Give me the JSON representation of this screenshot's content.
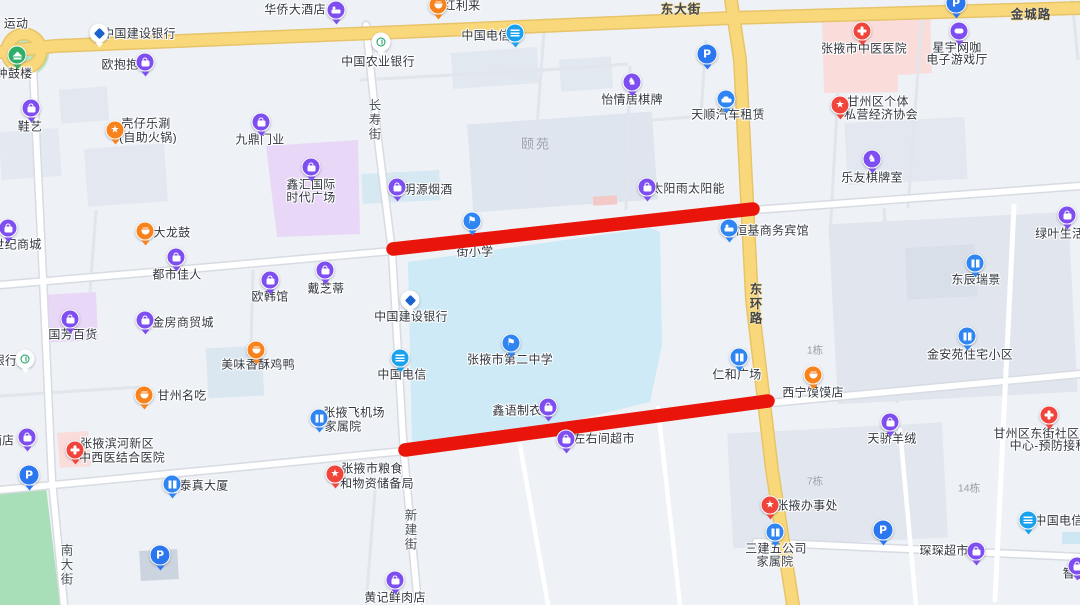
{
  "colors": {
    "highlight": "#e9150b",
    "purple": "#7e4ef1",
    "blue": "#2f85f2",
    "telecom": "#1ba2ef",
    "orange": "#f8821c",
    "red": "#f0453c",
    "green": "#2fae67",
    "white": "#ffffff",
    "parking": "#2b77f0",
    "road_yellow": "#f9d87b",
    "school_area": "#cdeaf6",
    "hospital_area": "#fadcdb",
    "commercial_area": "#e9d7f8",
    "park_green": "#a8dfb8"
  },
  "icons": {
    "shop": {
      "data_name": "bag-icon",
      "glyph": "bag"
    },
    "cart": {
      "data_name": "cart-icon",
      "glyph": "bag"
    },
    "hotel": {
      "data_name": "bed-icon",
      "glyph": "bed"
    },
    "hospital": {
      "data_name": "red-cross-icon",
      "glyph": "cross"
    },
    "star": {
      "data_name": "star-icon",
      "glyph": "txt",
      "char": "★"
    },
    "flag": {
      "data_name": "school-flag-icon",
      "glyph": "txt",
      "char": "⚑"
    },
    "knight": {
      "data_name": "chess-knight-icon",
      "glyph": "txt",
      "char": "♞"
    },
    "food": {
      "data_name": "food-bowl-icon",
      "glyph": "bowl"
    },
    "building": {
      "data_name": "building-icon",
      "glyph": "building"
    },
    "car": {
      "data_name": "car-icon",
      "glyph": "car"
    },
    "telecom": {
      "data_name": "telecom-icon",
      "glyph": "telecom"
    },
    "ccb": {
      "data_name": "ccb-bank-icon",
      "glyph": "ccb"
    },
    "abc": {
      "data_name": "abc-bank-icon",
      "glyph": "abc"
    },
    "pagoda": {
      "data_name": "pagoda-icon",
      "glyph": "pagoda"
    },
    "game": {
      "data_name": "game-icon",
      "glyph": "game"
    }
  },
  "highlight": {
    "segments": [
      {
        "x1": 393,
        "y1": 249,
        "x2": 753,
        "y2": 209
      },
      {
        "x1": 405,
        "y1": 450,
        "x2": 768,
        "y2": 401
      }
    ],
    "stroke_width": 13.5
  },
  "map": {
    "road_labels": [
      {
        "id": "dongdajie",
        "text": "东大街",
        "x": 681,
        "y": 8,
        "v": false,
        "on_yellow": true
      },
      {
        "id": "jinchenglu",
        "text": "金城路",
        "x": 1031,
        "y": 13,
        "v": false,
        "on_yellow": true
      },
      {
        "id": "donghuanlu",
        "text": "东环路",
        "x": 755,
        "y": 304,
        "v": true,
        "on_yellow": true
      },
      {
        "id": "changshoujie",
        "text": "长寿街",
        "x": 374,
        "y": 120,
        "v": true,
        "on_yellow": false
      },
      {
        "id": "xinjianjie",
        "text": "新建街",
        "x": 410,
        "y": 530,
        "v": true,
        "on_yellow": false
      },
      {
        "id": "nandajie",
        "text": "南大街",
        "x": 66,
        "y": 565,
        "v": true,
        "on_yellow": false
      }
    ],
    "area_labels": [
      {
        "id": "yiyuan",
        "text": "颐苑",
        "x": 536,
        "y": 143,
        "small": false
      },
      {
        "id": "dong-1",
        "text": "1栋",
        "x": 815,
        "y": 350,
        "small": true
      },
      {
        "id": "dong-7",
        "text": "7栋",
        "x": 815,
        "y": 481,
        "small": true
      },
      {
        "id": "dong-14",
        "text": "14栋",
        "x": 969,
        "y": 488,
        "small": true
      }
    ],
    "parking": [
      {
        "id": "parking-top-center",
        "x": 707,
        "y": 54
      },
      {
        "id": "parking-top-right",
        "x": 956,
        "y": 3
      },
      {
        "id": "parking-left",
        "x": 29,
        "y": 475
      },
      {
        "id": "parking-bottom-left",
        "x": 160,
        "y": 555
      },
      {
        "id": "parking-bottom-right",
        "x": 883,
        "y": 530
      }
    ],
    "pois": [
      {
        "id": "sports-fragment",
        "icon": "none",
        "color": "purple",
        "x": 16,
        "y": 23,
        "lines": [
          {
            "text": "运动",
            "cx": 16,
            "cy": 23
          }
        ]
      },
      {
        "id": "bell-drum-tower",
        "icon": "pagoda",
        "color": "green",
        "x": 17,
        "y": 55,
        "lines": [
          {
            "text": "钟鼓楼",
            "cx": 14,
            "cy": 73
          }
        ]
      },
      {
        "id": "ccb-bank-north",
        "icon": "ccb",
        "color": "white",
        "x": 99,
        "y": 33,
        "lines": [
          {
            "text": "中国建设银行",
            "cx": 139,
            "cy": 33
          }
        ]
      },
      {
        "id": "huaqiao-hotel",
        "icon": "hotel",
        "color": "purple",
        "x": 336,
        "y": 10,
        "lines": [
          {
            "text": "华侨大酒店",
            "cx": 295,
            "cy": 9
          }
        ]
      },
      {
        "id": "honglilai",
        "icon": "food",
        "color": "orange",
        "x": 438,
        "y": 5,
        "lines": [
          {
            "text": "红利来",
            "cx": 462,
            "cy": 5
          }
        ]
      },
      {
        "id": "china-telecom-north",
        "icon": "telecom",
        "color": "telecom",
        "x": 515,
        "y": 33,
        "lines": [
          {
            "text": "中国电信",
            "cx": 486,
            "cy": 35
          }
        ]
      },
      {
        "id": "ou-baobao",
        "icon": "shop",
        "color": "purple",
        "x": 145,
        "y": 62,
        "lines": [
          {
            "text": "欧抱抱",
            "cx": 120,
            "cy": 64
          }
        ]
      },
      {
        "id": "abc-bank",
        "icon": "abc",
        "color": "white",
        "x": 381,
        "y": 42,
        "lines": [
          {
            "text": "中国农业银行",
            "cx": 378,
            "cy": 61
          }
        ]
      },
      {
        "id": "xieyi-shoes",
        "icon": "shop",
        "color": "purple",
        "x": 31,
        "y": 108,
        "lines": [
          {
            "text": "鞋艺",
            "cx": 30,
            "cy": 126
          }
        ]
      },
      {
        "id": "kezai-hotpot",
        "icon": "star",
        "color": "orange",
        "x": 115,
        "y": 130,
        "lines": [
          {
            "text": "壳仔乐涮",
            "cx": 146,
            "cy": 123
          },
          {
            "text": "(自助火锅)",
            "cx": 148,
            "cy": 137
          }
        ]
      },
      {
        "id": "jiuding-doors",
        "icon": "shop",
        "color": "purple",
        "x": 261,
        "y": 122,
        "lines": [
          {
            "text": "九鼎门业",
            "cx": 260,
            "cy": 139
          }
        ]
      },
      {
        "id": "xinhui-plaza",
        "icon": "shop",
        "color": "purple",
        "x": 311,
        "y": 167,
        "lines": [
          {
            "text": "鑫汇国际",
            "cx": 311,
            "cy": 184
          },
          {
            "text": "时代广场",
            "cx": 311,
            "cy": 197
          }
        ]
      },
      {
        "id": "yiqingju-mahjong",
        "icon": "knight",
        "color": "purple",
        "x": 632,
        "y": 82,
        "lines": [
          {
            "text": "怡情居棋牌",
            "cx": 632,
            "cy": 99
          }
        ]
      },
      {
        "id": "tianshun-car-rental",
        "icon": "car",
        "color": "blue",
        "x": 726,
        "y": 99,
        "lines": [
          {
            "text": "天顺汽车租赁",
            "cx": 728,
            "cy": 114
          }
        ]
      },
      {
        "id": "xingyu-netcafe",
        "icon": "game",
        "color": "purple",
        "x": 959,
        "y": 31,
        "lines": [
          {
            "text": "星宇网咖",
            "cx": 957,
            "cy": 47
          },
          {
            "text": "电子游戏厅",
            "cx": 957,
            "cy": 59
          }
        ]
      },
      {
        "id": "zhangye-tcm-hospital",
        "icon": "hospital",
        "color": "red",
        "x": 862,
        "y": 31,
        "lines": [
          {
            "text": "张掖市中医医院",
            "cx": 864,
            "cy": 48
          }
        ]
      },
      {
        "id": "private-economy-association",
        "icon": "star",
        "color": "red",
        "x": 840,
        "y": 105,
        "lines": [
          {
            "text": "甘州区个体",
            "cx": 878,
            "cy": 101
          },
          {
            "text": "私营经济协会",
            "cx": 881,
            "cy": 114
          }
        ]
      },
      {
        "id": "leyou-chess-room",
        "icon": "knight",
        "color": "purple",
        "x": 872,
        "y": 159,
        "lines": [
          {
            "text": "乐友棋牌室",
            "cx": 872,
            "cy": 177
          }
        ]
      },
      {
        "id": "mingyuan-tobacco",
        "icon": "shop",
        "color": "purple",
        "x": 397,
        "y": 187,
        "lines": [
          {
            "text": "明源烟酒",
            "cx": 428,
            "cy": 189
          }
        ]
      },
      {
        "id": "taiyangyu-solar",
        "icon": "shop",
        "color": "purple",
        "x": 647,
        "y": 187,
        "lines": [
          {
            "text": "太阳雨太阳能",
            "cx": 688,
            "cy": 188
          }
        ]
      },
      {
        "id": "school-fragment",
        "icon": "flag",
        "color": "blue",
        "x": 472,
        "y": 221,
        "lines": [
          {
            "text": "街小学",
            "cx": 475,
            "cy": 251
          }
        ]
      },
      {
        "id": "hengji-hotel",
        "icon": "hotel",
        "color": "blue",
        "x": 729,
        "y": 228,
        "lines": [
          {
            "text": "恒基商务宾馆",
            "cx": 772,
            "cy": 230
          }
        ]
      },
      {
        "id": "lvye-life-supermarket",
        "icon": "cart",
        "color": "purple",
        "x": 1067,
        "y": 215,
        "lines": [
          {
            "text": "绿叶生活超市",
            "cx": 1072,
            "cy": 233
          }
        ]
      },
      {
        "id": "dongchen-ruijing",
        "icon": "building",
        "color": "blue",
        "x": 975,
        "y": 263,
        "lines": [
          {
            "text": "东辰瑞景",
            "cx": 976,
            "cy": 279
          }
        ]
      },
      {
        "id": "dalonggu",
        "icon": "food",
        "color": "orange",
        "x": 145,
        "y": 231,
        "lines": [
          {
            "text": "大龙鼓",
            "cx": 172,
            "cy": 232
          }
        ]
      },
      {
        "id": "dushi-jiaren",
        "icon": "shop",
        "color": "purple",
        "x": 176,
        "y": 257,
        "lines": [
          {
            "text": "都市佳人",
            "cx": 177,
            "cy": 274
          }
        ]
      },
      {
        "id": "ouhan-guan",
        "icon": "shop",
        "color": "purple",
        "x": 270,
        "y": 280,
        "lines": [
          {
            "text": "欧韩馆",
            "cx": 270,
            "cy": 296
          }
        ]
      },
      {
        "id": "daizhidi",
        "icon": "shop",
        "color": "purple",
        "x": 325,
        "y": 270,
        "lines": [
          {
            "text": "戴芝蒂",
            "cx": 326,
            "cy": 288
          }
        ]
      },
      {
        "id": "shiji-mall",
        "icon": "cart",
        "color": "purple",
        "x": 8,
        "y": 228,
        "lines": [
          {
            "text": "世纪商城",
            "cx": 17,
            "cy": 244
          }
        ]
      },
      {
        "id": "ccb-bank-mid",
        "icon": "ccb",
        "color": "white",
        "x": 410,
        "y": 300,
        "lines": [
          {
            "text": "中国建设银行",
            "cx": 411,
            "cy": 316
          }
        ]
      },
      {
        "id": "guofang-department-store",
        "icon": "shop",
        "color": "purple",
        "x": 70,
        "y": 319,
        "lines": [
          {
            "text": "国芳百货",
            "cx": 73,
            "cy": 334
          }
        ]
      },
      {
        "id": "jinfang-trade-city",
        "icon": "shop",
        "color": "purple",
        "x": 145,
        "y": 320,
        "lines": [
          {
            "text": "金房商贸城",
            "cx": 183,
            "cy": 322
          }
        ]
      },
      {
        "id": "meiwei-chicken-duck",
        "icon": "food",
        "color": "orange",
        "x": 256,
        "y": 350,
        "lines": [
          {
            "text": "美味香酥鸡鸭",
            "cx": 258,
            "cy": 364
          }
        ]
      },
      {
        "id": "zhangye-no2-middle-school",
        "icon": "flag",
        "color": "blue",
        "x": 511,
        "y": 343,
        "lines": [
          {
            "text": "张掖市第二中学",
            "cx": 510,
            "cy": 359
          }
        ]
      },
      {
        "id": "china-telecom-mid",
        "icon": "telecom",
        "color": "telecom",
        "x": 400,
        "y": 358,
        "lines": [
          {
            "text": "中国电信",
            "cx": 402,
            "cy": 374
          }
        ]
      },
      {
        "id": "renhe-plaza",
        "icon": "building",
        "color": "blue",
        "x": 739,
        "y": 357,
        "lines": [
          {
            "text": "仁和广场",
            "cx": 737,
            "cy": 374
          }
        ]
      },
      {
        "id": "xining-momo-shop",
        "icon": "food",
        "color": "orange",
        "x": 813,
        "y": 375,
        "lines": [
          {
            "text": "西宁馍馍店",
            "cx": 813,
            "cy": 392
          }
        ]
      },
      {
        "id": "jinanyuan-residence",
        "icon": "building",
        "color": "blue",
        "x": 967,
        "y": 336,
        "lines": [
          {
            "text": "金安苑住宅小区",
            "cx": 970,
            "cy": 354
          }
        ]
      },
      {
        "id": "ganzhou-snacks",
        "icon": "food",
        "color": "orange",
        "x": 144,
        "y": 395,
        "lines": [
          {
            "text": "甘州名吃",
            "cx": 182,
            "cy": 395
          }
        ]
      },
      {
        "id": "bank-fragment-left",
        "icon": "abc",
        "color": "white",
        "x": 25,
        "y": 359,
        "lines": [
          {
            "text": "银行",
            "cx": 5,
            "cy": 360
          }
        ]
      },
      {
        "id": "shop-fragment-left",
        "icon": "shop",
        "color": "purple",
        "x": 27,
        "y": 437,
        "lines": [
          {
            "text": "酒店",
            "cx": 2,
            "cy": 440
          }
        ]
      },
      {
        "id": "airport-family-compound",
        "icon": "building",
        "color": "blue",
        "x": 319,
        "y": 418,
        "lines": [
          {
            "text": "张掖飞机场",
            "cx": 354,
            "cy": 412
          },
          {
            "text": "家属院",
            "cx": 343,
            "cy": 426
          }
        ]
      },
      {
        "id": "binhe-hospital",
        "icon": "hospital",
        "color": "red",
        "x": 75,
        "y": 450,
        "lines": [
          {
            "text": "张掖滨河新区",
            "cx": 117,
            "cy": 443
          },
          {
            "text": "中西医结合医院",
            "cx": 122,
            "cy": 457
          }
        ]
      },
      {
        "id": "grain-reserve-bureau",
        "icon": "star",
        "color": "red",
        "x": 335,
        "y": 474,
        "lines": [
          {
            "text": "张掖市粮食",
            "cx": 372,
            "cy": 468
          },
          {
            "text": "和物资储备局",
            "cx": 377,
            "cy": 483
          }
        ]
      },
      {
        "id": "taizhen-tower",
        "icon": "building",
        "color": "blue",
        "x": 172,
        "y": 484,
        "lines": [
          {
            "text": "泰真大厦",
            "cx": 204,
            "cy": 485
          }
        ]
      },
      {
        "id": "xinyu-garment",
        "icon": "shop",
        "color": "purple",
        "x": 548,
        "y": 407,
        "lines": [
          {
            "text": "鑫语制衣",
            "cx": 517,
            "cy": 410
          }
        ]
      },
      {
        "id": "zuoyoujian-supermarket",
        "icon": "shop",
        "color": "purple",
        "x": 566,
        "y": 439,
        "lines": [
          {
            "text": "左右间超市",
            "cx": 604,
            "cy": 438
          }
        ]
      },
      {
        "id": "tianjiao-cashmere",
        "icon": "shop",
        "color": "purple",
        "x": 890,
        "y": 422,
        "lines": [
          {
            "text": "天骄羊绒",
            "cx": 892,
            "cy": 438
          }
        ]
      },
      {
        "id": "dongjie-community-clinic",
        "icon": "hospital",
        "color": "red",
        "x": 1049,
        "y": 415,
        "lines": [
          {
            "text": "甘州区东街社区卫生服务",
            "cx": 1061,
            "cy": 433
          },
          {
            "text": "中心-预防接种门诊",
            "cx": 1061,
            "cy": 445
          }
        ]
      },
      {
        "id": "zhangye-office",
        "icon": "star",
        "color": "red",
        "x": 770,
        "y": 505,
        "lines": [
          {
            "text": "张掖办事处",
            "cx": 807,
            "cy": 505
          }
        ]
      },
      {
        "id": "sanjianwu-family-compound",
        "icon": "building",
        "color": "blue",
        "x": 775,
        "y": 532,
        "lines": [
          {
            "text": "三建五公司",
            "cx": 776,
            "cy": 548
          },
          {
            "text": "家属院",
            "cx": 775,
            "cy": 561
          }
        ]
      },
      {
        "id": "china-telecom-southeast",
        "icon": "telecom",
        "color": "telecom",
        "x": 1028,
        "y": 520,
        "lines": [
          {
            "text": "中国电信",
            "cx": 1059,
            "cy": 520
          }
        ]
      },
      {
        "id": "chenchen-supermarket",
        "icon": "cart",
        "color": "purple",
        "x": 976,
        "y": 551,
        "lines": [
          {
            "text": "琛琛超市",
            "cx": 944,
            "cy": 550
          }
        ]
      },
      {
        "id": "zhi-fragment",
        "icon": "shop",
        "color": "purple",
        "x": 1077,
        "y": 566,
        "lines": [
          {
            "text": "智能",
            "cx": 1075,
            "cy": 573
          }
        ]
      },
      {
        "id": "huangji-meat-shop",
        "icon": "shop",
        "color": "purple",
        "x": 395,
        "y": 580,
        "lines": [
          {
            "text": "黄记鲜肉店",
            "cx": 395,
            "cy": 597
          }
        ]
      }
    ]
  }
}
